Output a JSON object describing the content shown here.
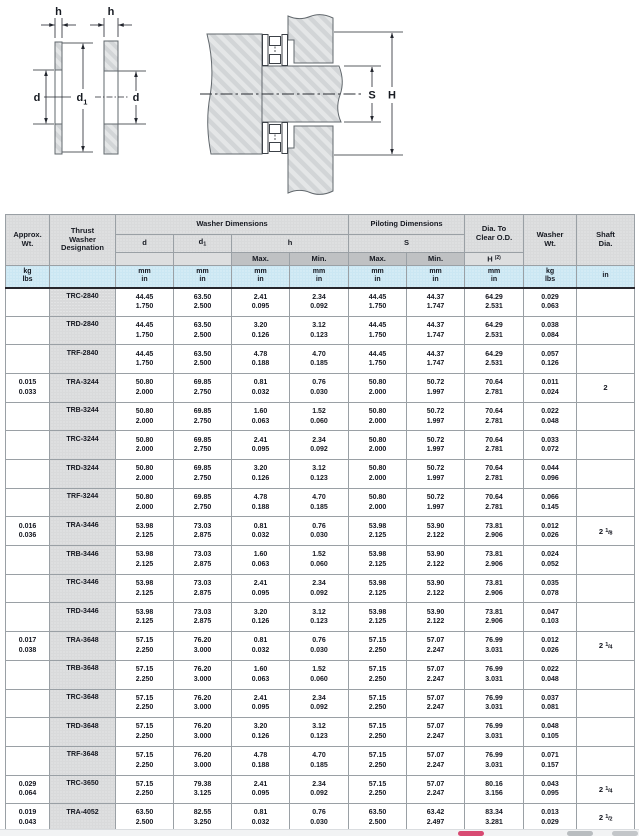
{
  "colors": {
    "accent_pink": "#d84a72",
    "units_row_blue": "#cbe7f3",
    "header_grey": "#d9dadb",
    "subheader_grey": "#bfc1c3",
    "hatch_grey": "#d2d5d7"
  },
  "diagrams": {
    "labels": {
      "h": "h",
      "d": "d",
      "d1_base": "d",
      "d1_sub": "1",
      "s": "S",
      "H": "H"
    }
  },
  "table": {
    "headers": {
      "approx_wt": "Approx.\nWt.",
      "designation": "Thrust\nWasher\nDesignation",
      "washer_dims": "Washer Dimensions",
      "piloting_dims": "Piloting Dimensions",
      "dia_clear": "Dia. To\nClear O.D.",
      "washer_wt": "Washer\nWt.",
      "shaft_dia": "Shaft\nDia.",
      "d": "d",
      "d1_base": "d",
      "d1_sub": "1",
      "h": "h",
      "s": "S",
      "max": "Max.",
      "min": "Min.",
      "H_base": "H",
      "H_sup": "(2)"
    },
    "units": {
      "kg_lbs": "kg\nlbs",
      "mm_in": "mm\nin",
      "in": "in"
    },
    "rows": [
      {
        "wt": null,
        "desig": "TRC-2840",
        "cells": [
          [
            "44.45",
            "1.750"
          ],
          [
            "63.50",
            "2.500"
          ],
          [
            "2.41",
            "0.095"
          ],
          [
            "2.34",
            "0.092"
          ],
          [
            "44.45",
            "1.750"
          ],
          [
            "44.37",
            "1.747"
          ],
          [
            "64.29",
            "2.531"
          ],
          [
            "0.029",
            "0.063"
          ]
        ],
        "shaft": null
      },
      {
        "wt": null,
        "desig": "TRD-2840",
        "cells": [
          [
            "44.45",
            "1.750"
          ],
          [
            "63.50",
            "2.500"
          ],
          [
            "3.20",
            "0.126"
          ],
          [
            "3.12",
            "0.123"
          ],
          [
            "44.45",
            "1.750"
          ],
          [
            "44.37",
            "1.747"
          ],
          [
            "64.29",
            "2.531"
          ],
          [
            "0.038",
            "0.084"
          ]
        ],
        "shaft": null
      },
      {
        "wt": null,
        "desig": "TRF-2840",
        "cells": [
          [
            "44.45",
            "1.750"
          ],
          [
            "63.50",
            "2.500"
          ],
          [
            "4.78",
            "0.188"
          ],
          [
            "4.70",
            "0.185"
          ],
          [
            "44.45",
            "1.750"
          ],
          [
            "44.37",
            "1.747"
          ],
          [
            "64.29",
            "2.531"
          ],
          [
            "0.057",
            "0.126"
          ]
        ],
        "shaft": null
      },
      {
        "wt": [
          "0.015",
          "0.033"
        ],
        "desig": "TRA-3244",
        "cells": [
          [
            "50.80",
            "2.000"
          ],
          [
            "69.85",
            "2.750"
          ],
          [
            "0.81",
            "0.032"
          ],
          [
            "0.76",
            "0.030"
          ],
          [
            "50.80",
            "2.000"
          ],
          [
            "50.72",
            "1.997"
          ],
          [
            "70.64",
            "2.781"
          ],
          [
            "0.011",
            "0.024"
          ]
        ],
        "shaft": "2"
      },
      {
        "wt": null,
        "desig": "TRB-3244",
        "cells": [
          [
            "50.80",
            "2.000"
          ],
          [
            "69.85",
            "2.750"
          ],
          [
            "1.60",
            "0.063"
          ],
          [
            "1.52",
            "0.060"
          ],
          [
            "50.80",
            "2.000"
          ],
          [
            "50.72",
            "1.997"
          ],
          [
            "70.64",
            "2.781"
          ],
          [
            "0.022",
            "0.048"
          ]
        ],
        "shaft": null
      },
      {
        "wt": null,
        "desig": "TRC-3244",
        "cells": [
          [
            "50.80",
            "2.000"
          ],
          [
            "69.85",
            "2.750"
          ],
          [
            "2.41",
            "0.095"
          ],
          [
            "2.34",
            "0.092"
          ],
          [
            "50.80",
            "2.000"
          ],
          [
            "50.72",
            "1.997"
          ],
          [
            "70.64",
            "2.781"
          ],
          [
            "0.033",
            "0.072"
          ]
        ],
        "shaft": null
      },
      {
        "wt": null,
        "desig": "TRD-3244",
        "cells": [
          [
            "50.80",
            "2.000"
          ],
          [
            "69.85",
            "2.750"
          ],
          [
            "3.20",
            "0.126"
          ],
          [
            "3.12",
            "0.123"
          ],
          [
            "50.80",
            "2.000"
          ],
          [
            "50.72",
            "1.997"
          ],
          [
            "70.64",
            "2.781"
          ],
          [
            "0.044",
            "0.096"
          ]
        ],
        "shaft": null
      },
      {
        "wt": null,
        "desig": "TRF-3244",
        "cells": [
          [
            "50.80",
            "2.000"
          ],
          [
            "69.85",
            "2.750"
          ],
          [
            "4.78",
            "0.188"
          ],
          [
            "4.70",
            "0.185"
          ],
          [
            "50.80",
            "2.000"
          ],
          [
            "50.72",
            "1.997"
          ],
          [
            "70.64",
            "2.781"
          ],
          [
            "0.066",
            "0.145"
          ]
        ],
        "shaft": null
      },
      {
        "wt": [
          "0.016",
          "0.036"
        ],
        "desig": "TRA-3446",
        "cells": [
          [
            "53.98",
            "2.125"
          ],
          [
            "73.03",
            "2.875"
          ],
          [
            "0.81",
            "0.032"
          ],
          [
            "0.76",
            "0.030"
          ],
          [
            "53.98",
            "2.125"
          ],
          [
            "53.90",
            "2.122"
          ],
          [
            "73.81",
            "2.906"
          ],
          [
            "0.012",
            "0.026"
          ]
        ],
        "shaft": "2 1/8"
      },
      {
        "wt": null,
        "desig": "TRB-3446",
        "cells": [
          [
            "53.98",
            "2.125"
          ],
          [
            "73.03",
            "2.875"
          ],
          [
            "1.60",
            "0.063"
          ],
          [
            "1.52",
            "0.060"
          ],
          [
            "53.98",
            "2.125"
          ],
          [
            "53.90",
            "2.122"
          ],
          [
            "73.81",
            "2.906"
          ],
          [
            "0.024",
            "0.052"
          ]
        ],
        "shaft": null
      },
      {
        "wt": null,
        "desig": "TRC-3446",
        "cells": [
          [
            "53.98",
            "2.125"
          ],
          [
            "73.03",
            "2.875"
          ],
          [
            "2.41",
            "0.095"
          ],
          [
            "2.34",
            "0.092"
          ],
          [
            "53.98",
            "2.125"
          ],
          [
            "53.90",
            "2.122"
          ],
          [
            "73.81",
            "2.906"
          ],
          [
            "0.035",
            "0.078"
          ]
        ],
        "shaft": null
      },
      {
        "wt": null,
        "desig": "TRD-3446",
        "cells": [
          [
            "53.98",
            "2.125"
          ],
          [
            "73.03",
            "2.875"
          ],
          [
            "3.20",
            "0.126"
          ],
          [
            "3.12",
            "0.123"
          ],
          [
            "53.98",
            "2.125"
          ],
          [
            "53.90",
            "2.122"
          ],
          [
            "73.81",
            "2.906"
          ],
          [
            "0.047",
            "0.103"
          ]
        ],
        "shaft": null
      },
      {
        "wt": [
          "0.017",
          "0.038"
        ],
        "desig": "TRA-3648",
        "cells": [
          [
            "57.15",
            "2.250"
          ],
          [
            "76.20",
            "3.000"
          ],
          [
            "0.81",
            "0.032"
          ],
          [
            "0.76",
            "0.030"
          ],
          [
            "57.15",
            "2.250"
          ],
          [
            "57.07",
            "2.247"
          ],
          [
            "76.99",
            "3.031"
          ],
          [
            "0.012",
            "0.026"
          ]
        ],
        "shaft": "2 1/4"
      },
      {
        "wt": null,
        "desig": "TRB-3648",
        "cells": [
          [
            "57.15",
            "2.250"
          ],
          [
            "76.20",
            "3.000"
          ],
          [
            "1.60",
            "0.063"
          ],
          [
            "1.52",
            "0.060"
          ],
          [
            "57.15",
            "2.250"
          ],
          [
            "57.07",
            "2.247"
          ],
          [
            "76.99",
            "3.031"
          ],
          [
            "0.022",
            "0.048"
          ]
        ],
        "shaft": null
      },
      {
        "wt": null,
        "desig": "TRC-3648",
        "cells": [
          [
            "57.15",
            "2.250"
          ],
          [
            "76.20",
            "3.000"
          ],
          [
            "2.41",
            "0.095"
          ],
          [
            "2.34",
            "0.092"
          ],
          [
            "57.15",
            "2.250"
          ],
          [
            "57.07",
            "2.247"
          ],
          [
            "76.99",
            "3.031"
          ],
          [
            "0.037",
            "0.081"
          ]
        ],
        "shaft": null
      },
      {
        "wt": null,
        "desig": "TRD-3648",
        "cells": [
          [
            "57.15",
            "2.250"
          ],
          [
            "76.20",
            "3.000"
          ],
          [
            "3.20",
            "0.126"
          ],
          [
            "3.12",
            "0.123"
          ],
          [
            "57.15",
            "2.250"
          ],
          [
            "57.07",
            "2.247"
          ],
          [
            "76.99",
            "3.031"
          ],
          [
            "0.048",
            "0.105"
          ]
        ],
        "shaft": null
      },
      {
        "wt": null,
        "desig": "TRF-3648",
        "cells": [
          [
            "57.15",
            "2.250"
          ],
          [
            "76.20",
            "3.000"
          ],
          [
            "4.78",
            "0.188"
          ],
          [
            "4.70",
            "0.185"
          ],
          [
            "57.15",
            "2.250"
          ],
          [
            "57.07",
            "2.247"
          ],
          [
            "76.99",
            "3.031"
          ],
          [
            "0.071",
            "0.157"
          ]
        ],
        "shaft": null
      },
      {
        "wt": [
          "0.029",
          "0.064"
        ],
        "desig": "TRC-3650",
        "cells": [
          [
            "57.15",
            "2.250"
          ],
          [
            "79.38",
            "3.125"
          ],
          [
            "2.41",
            "0.095"
          ],
          [
            "2.34",
            "0.092"
          ],
          [
            "57.15",
            "2.250"
          ],
          [
            "57.07",
            "2.247"
          ],
          [
            "80.16",
            "3.156"
          ],
          [
            "0.043",
            "0.095"
          ]
        ],
        "shaft": "2 1/4"
      },
      {
        "wt": [
          "0.019",
          "0.043"
        ],
        "desig": "TRA-4052",
        "cells": [
          [
            "63.50",
            "2.500"
          ],
          [
            "82.55",
            "3.250"
          ],
          [
            "0.81",
            "0.032"
          ],
          [
            "0.76",
            "0.030"
          ],
          [
            "63.50",
            "2.500"
          ],
          [
            "63.42",
            "2.497"
          ],
          [
            "83.34",
            "3.281"
          ],
          [
            "0.013",
            "0.029"
          ]
        ],
        "shaft": "2 1/2"
      }
    ]
  }
}
